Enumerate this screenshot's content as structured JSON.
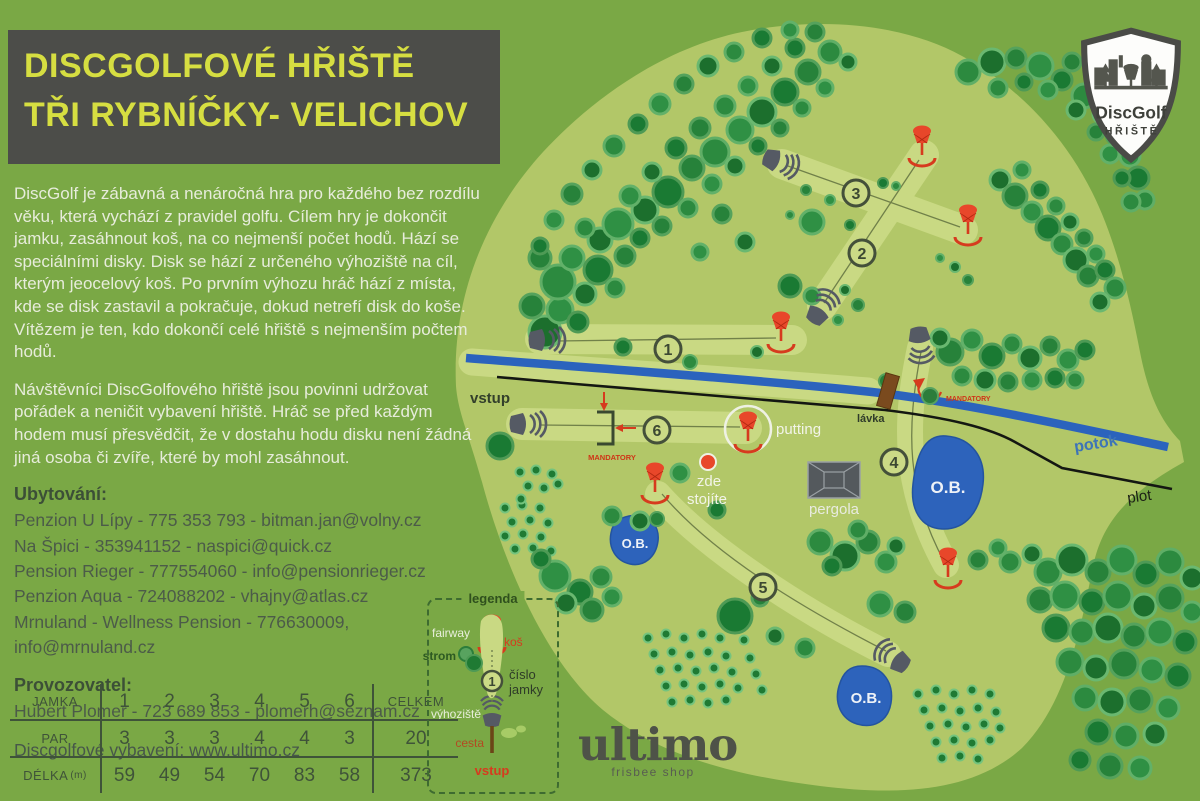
{
  "title": {
    "line1": "DISCGOLFOVÉ HŘIŠTĚ",
    "line2": "TŘI RYBNÍČKY- VELICHOV"
  },
  "intro": "DiscGolf je zábavná a nenáročná hra pro každého bez rozdílu věku, která vychází z pravidel golfu. Cílem hry je dokončit jamku, zasáhnout koš, na co nejmenší počet hodů. Hází se speciálními disky. Disk se hází z určeného výhoziště na cíl, kterým jeocelový koš. Po prvním výhozu hráč hází z místa, kde se disk zastavil a pokračuje, dokud netrefí disk do koše. Vítězem je ten, kdo dokončí celé hřiště s nejmenším počtem hodů.",
  "rules": "Návštěvníci DiscGolfového  hřiště jsou povinni udržovat pořádek a neničit vybavení hřiště. Hráč se před každým hodem musí přesvědčit, že v dostahu hodu disku není žádná jiná osoba či zvíře, které by mohl zasáhnout.",
  "accommodation": {
    "heading": "Ubytování:",
    "items": [
      "Penzion U Lípy - 775 353 793 - bitman.jan@volny.cz",
      "Na Špici -  353941152 - naspici@quick.cz",
      "Pension Rieger - 777554060 - info@pensionrieger.cz",
      "Penzion Aqua - 724088202 - vhajny@atlas.cz",
      "Mrnuland - Wellness Pension - 776630009, info@mrnuland.cz"
    ]
  },
  "operator": {
    "heading": "Provozovatel:",
    "line": "Hubert Plomer - 723 689 853 - plomerh@seznam.cz"
  },
  "equipment": "Discgolfové vybavení: www.ultimo.cz",
  "score_table": {
    "hole_label": "JAMKA",
    "total_label": "CELKEM",
    "holes": [
      "1",
      "2",
      "3",
      "4",
      "5",
      "6"
    ],
    "par_label": "PAR",
    "par": [
      "3",
      "3",
      "3",
      "4",
      "4",
      "3"
    ],
    "par_total": "20",
    "length_label": "DÉLKA",
    "length_unit": "(m)",
    "lengths": [
      "59",
      "49",
      "54",
      "70",
      "83",
      "58"
    ],
    "length_total": "373"
  },
  "legend": {
    "title": "legenda",
    "fairway": "fairway",
    "basket": "koš",
    "tree": "strom",
    "hole_number": "1",
    "hole_number_label1": "číslo",
    "hole_number_label2": "jamky",
    "tee": "výhoziště",
    "path": "cesta",
    "entrance": "vstup"
  },
  "map": {
    "entrance": "vstup",
    "putting": "putting",
    "here_line1": "zde",
    "here_line2": "stojíte",
    "pergola": "pergola",
    "bridge": "lávka",
    "stream": "potok",
    "fence": "plot",
    "mandatory": "MANDATORY",
    "ob": "O.B.",
    "hole_numbers": [
      "1",
      "2",
      "3",
      "4",
      "5",
      "6"
    ]
  },
  "badge": {
    "name": "DiscGolf",
    "sub": "HŘIŠTĚ"
  },
  "ultimo": {
    "name": "ultimo",
    "tagline": "frisbee shop"
  },
  "colors": {
    "background": "#7aa845",
    "course_area": "#b2c768",
    "fairway": "#c9d983",
    "title_bg": "#4c4d49",
    "title_text": "#d6de41",
    "accent_red": "#d63b1e",
    "water": "#2d63bb",
    "dark_text": "#3f5339"
  }
}
